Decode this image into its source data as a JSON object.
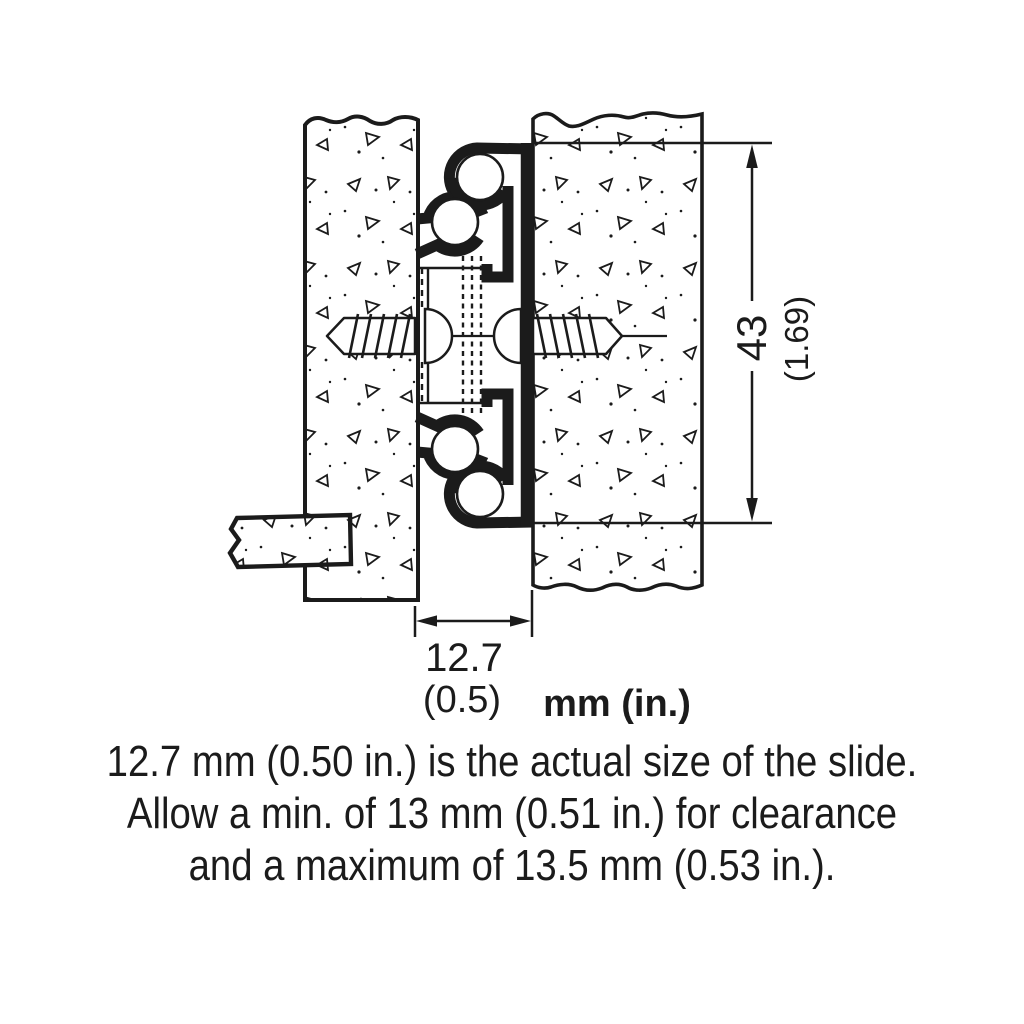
{
  "diagram": {
    "title_semantic": "drawer-slide-cross-section-installation-diagram",
    "units_label": "mm (in.)",
    "height_dim": {
      "mm": "43",
      "in": "(1.69)"
    },
    "width_dim": {
      "mm": "12.7",
      "in": "(0.5)"
    },
    "caption": {
      "line1": "12.7 mm (0.50 in.) is the actual size of the slide.",
      "line2": "Allow a min. of 13 mm (0.51 in.) for clearance",
      "line3": "and a maximum of 13.5 mm (0.53 in.)."
    },
    "colors": {
      "ink": "#1b1b1b",
      "paper": "#ffffff"
    }
  }
}
